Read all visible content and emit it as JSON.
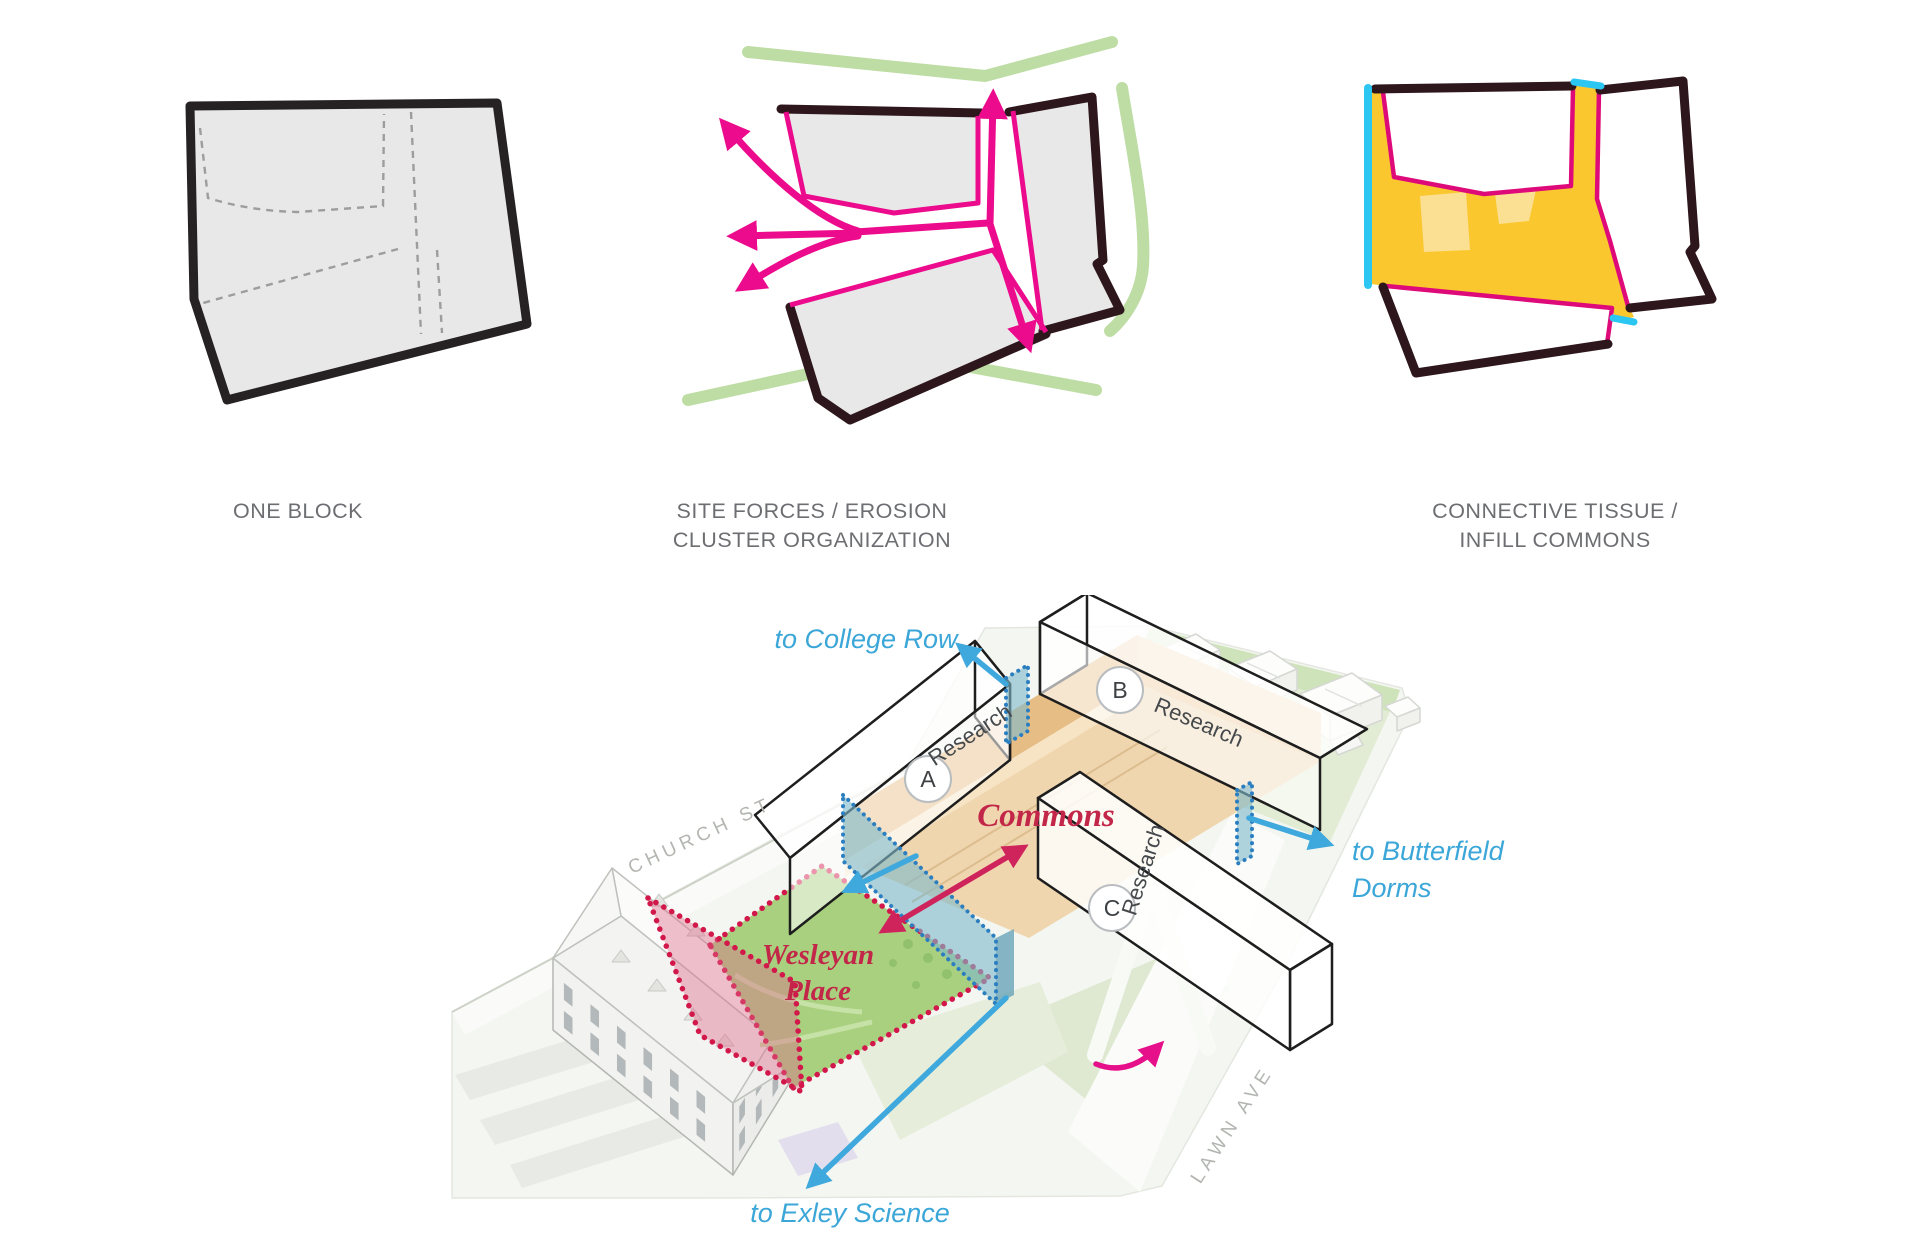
{
  "diagrams": {
    "one_block": {
      "caption": "ONE BLOCK"
    },
    "site_forces": {
      "caption_line1": "SITE FORCES / EROSION",
      "caption_line2": "CLUSTER ORGANIZATION"
    },
    "connective": {
      "caption_line1": "CONNECTIVE TISSUE /",
      "caption_line2": "INFILL COMMONS"
    }
  },
  "site_plan": {
    "labels": {
      "to_college_row": "to College Row",
      "to_butterfield_line1": "to Butterfield",
      "to_butterfield_line2": "Dorms",
      "to_exley_science": "to Exley Science",
      "commons": "Commons",
      "wesleyan_place_line1": "Wesleyan",
      "wesleyan_place_line2": "Place",
      "church_st": "CHURCH ST",
      "lawn_ave": "LAWN AVE"
    },
    "buildings": {
      "a": {
        "letter": "A",
        "label": "Research"
      },
      "b": {
        "letter": "B",
        "label": "Research"
      },
      "c": {
        "letter": "C",
        "label": "Research"
      }
    }
  },
  "colors": {
    "magenta_arrow": "#ec0b8c",
    "magenta_outline": "#df0a79",
    "dark_outline": "#2d161c",
    "block_gray": "#e8e8e8",
    "green_accent": "#bedda4",
    "yellow_infill": "#fac82e",
    "yellow_light": "#fbdf92",
    "cyan_accent": "#2cc6f2",
    "caption_gray": "#6d6e71",
    "blue_label": "#3ba6d8",
    "red_serif_label": "#c22648",
    "red_dotted": "#d2174a",
    "crimson_arrow": "#cf235c",
    "lawn_green": "#a8d07e",
    "commons_floor": "#f0d6ae",
    "commons_wall": "#e6bd85",
    "teal_glass": "#7ebacd",
    "street_label_gray": "#b3b6b0"
  }
}
